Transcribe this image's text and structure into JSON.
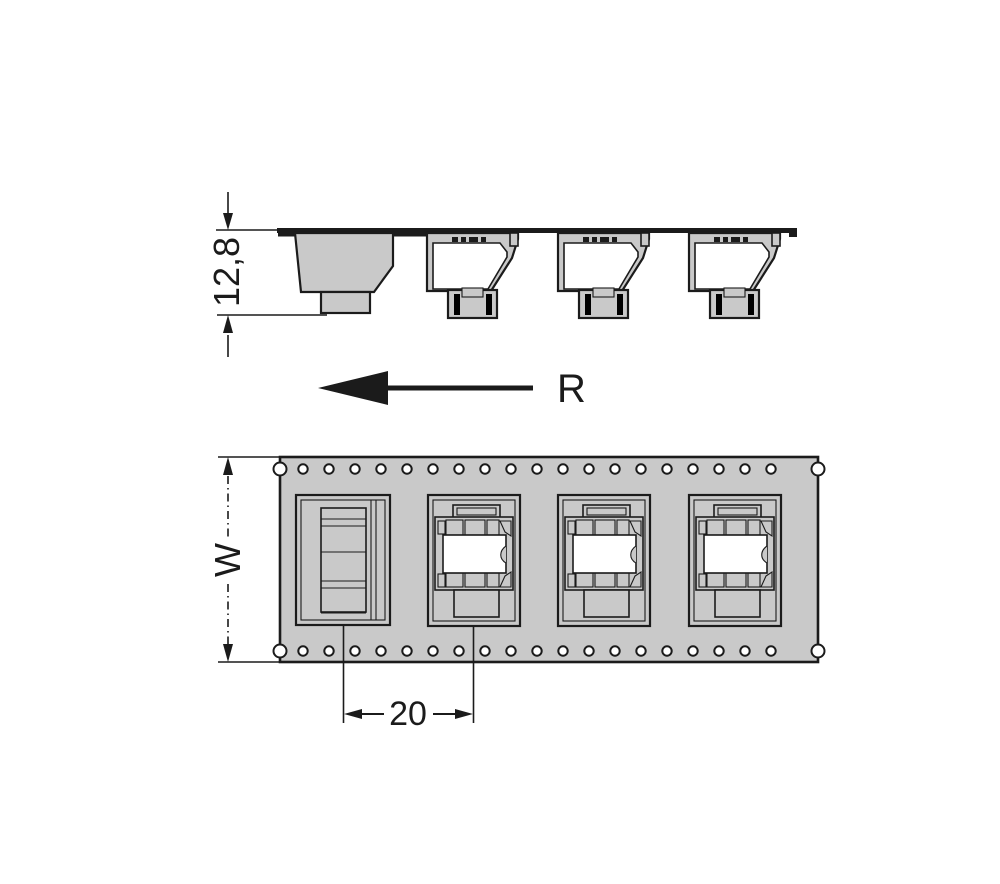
{
  "drawing": {
    "side_view": {
      "component_count": 4,
      "height_dimension": {
        "label": "12,8"
      }
    },
    "direction_arrow": {
      "label": "R"
    },
    "top_view": {
      "pocket_count": 4,
      "sprocket_hole_rows": 2,
      "sprocket_holes_per_row": 19,
      "width_dimension": {
        "label": "W"
      },
      "pitch_dimension": {
        "label": "20"
      }
    },
    "colors": {
      "tape_gray": "#c9c9c9",
      "line": "#1b1b1b",
      "background": "#ffffff",
      "cavity_white": "#ffffff"
    }
  }
}
